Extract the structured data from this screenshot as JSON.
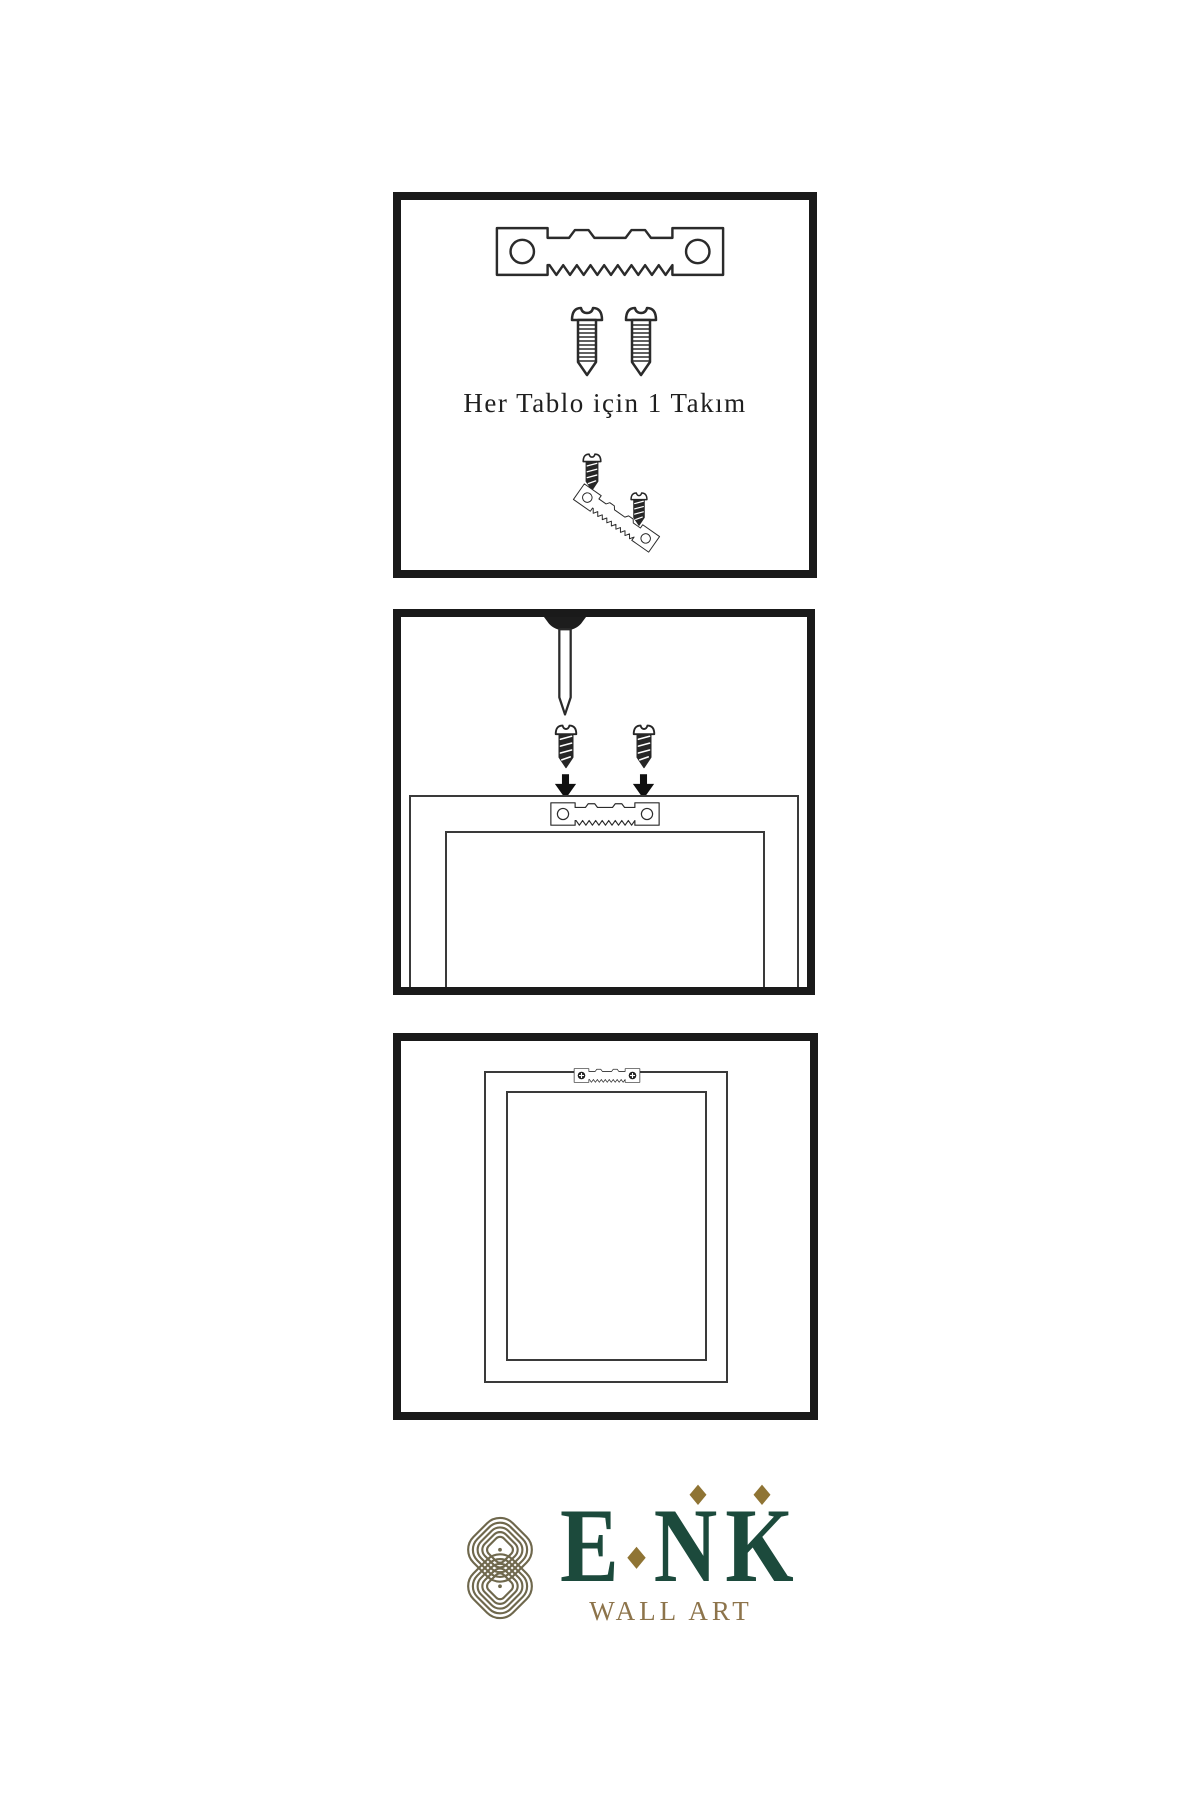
{
  "document": {
    "type": "product-instruction-sheet",
    "language": "tr",
    "background": "#ffffff"
  },
  "steps": [
    {
      "name": "hardware-kit",
      "caption": "Her Tablo için 1 Takım",
      "icons": [
        "sawtooth-hanger",
        "screw-light",
        "screw-light",
        "screw-dark",
        "tilted-sawtooth-hanger",
        "screw-dark"
      ]
    },
    {
      "name": "attach-hanger-with-screws",
      "caption": "",
      "icons": [
        "nail",
        "screw-dark",
        "screw-dark",
        "arrow-down",
        "arrow-down",
        "frame-back",
        "sawtooth-hanger"
      ]
    },
    {
      "name": "frame-hung-on-wall",
      "caption": "",
      "icons": [
        "frame-back",
        "sawtooth-hanger-fastened"
      ]
    }
  ],
  "brand": {
    "name": "ENK",
    "letters": [
      "E",
      "N",
      "K"
    ],
    "tagline": "WALL ART"
  },
  "colors": {
    "panel_border": "#1a1a1a",
    "line_art": "#2b2b2b",
    "screw_dark": "#262626",
    "brand_green": "#1c4a3c",
    "brand_gold": "#8d744b",
    "knot_gold": "#6f684d",
    "diamond_gold": "#8f7434"
  }
}
